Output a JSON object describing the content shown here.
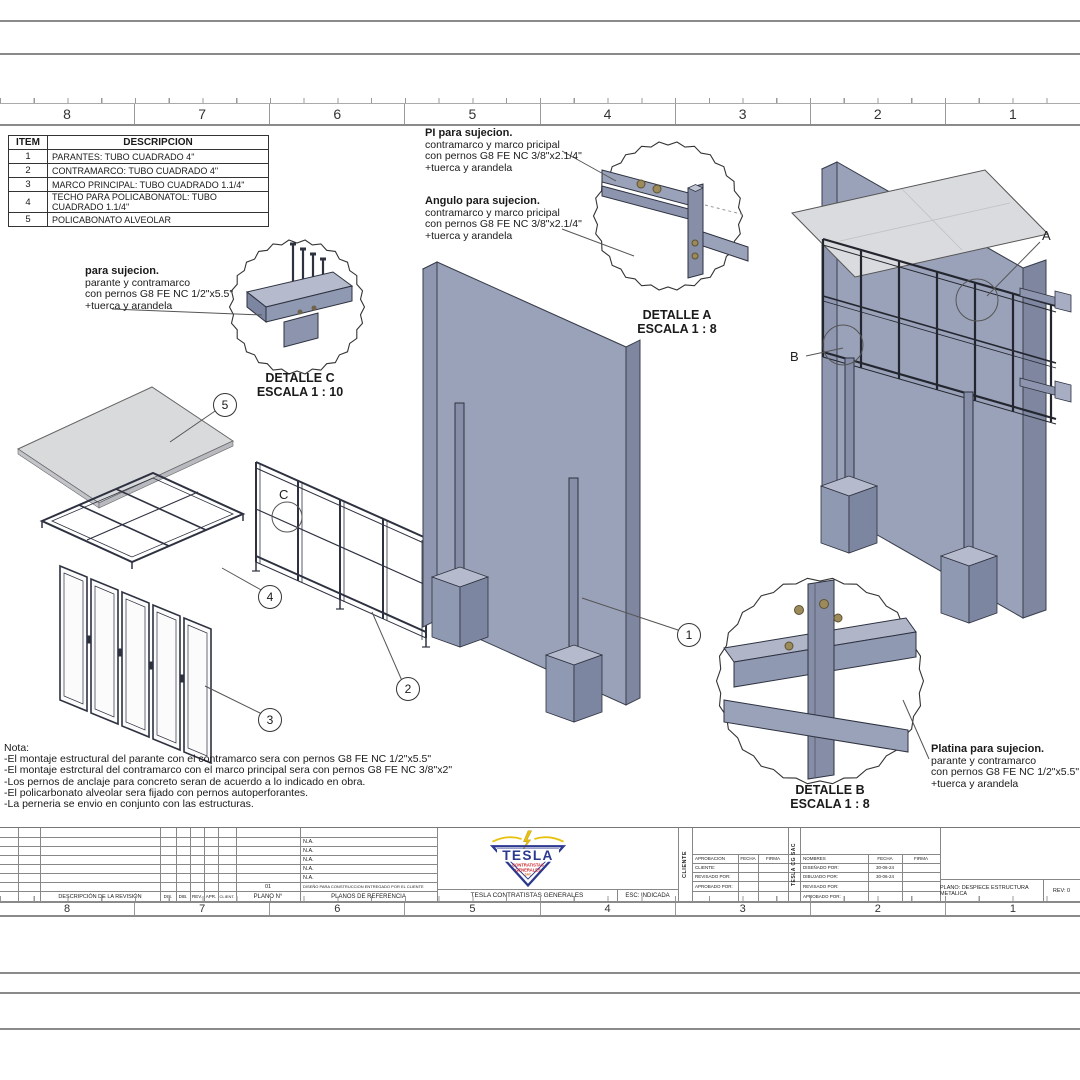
{
  "rulers": {
    "top": [
      "8",
      "7",
      "6",
      "5",
      "4",
      "3",
      "2",
      "1"
    ],
    "bottom": [
      "8",
      "7",
      "6",
      "5",
      "4",
      "3",
      "2",
      "1"
    ]
  },
  "parts_table": {
    "headers": {
      "item": "ITEM",
      "desc": "DESCRIPCION"
    },
    "rows": [
      {
        "item": "1",
        "desc": "PARANTES: TUBO CUADRADO 4\""
      },
      {
        "item": "2",
        "desc": "CONTRAMARCO: TUBO CUADRADO 4\""
      },
      {
        "item": "3",
        "desc": "MARCO PRINCIPAL: TUBO CUADRADO 1.1/4\""
      },
      {
        "item": "4",
        "desc": "TECHO PARA POLICABONATOL: TUBO CUADRADO 1.1/4\""
      },
      {
        "item": "5",
        "desc": "POLICABONATO ALVEOLAR"
      }
    ]
  },
  "annotations": {
    "pi": {
      "title": "PI para sujecion.",
      "lines": [
        "contramarco y marco pricipal",
        "con pernos G8 FE NC 3/8\"x2.1/4\"",
        "+tuerca y arandela"
      ]
    },
    "angulo": {
      "title": "Angulo para sujecion.",
      "lines": [
        "contramarco y marco pricipal",
        "con pernos G8 FE NC 3/8\"x2.1/4\"",
        "+tuerca y arandela"
      ]
    },
    "parante": {
      "title": "para sujecion.",
      "lines": [
        "parante y contramarco",
        "con pernos G8 FE NC 1/2\"x5.5\"",
        "+tuerca y arandela"
      ]
    },
    "platina": {
      "title": "Platina para sujecion.",
      "lines": [
        "parante y contramarco",
        "con pernos G8 FE NC 1/2\"x5.5\"",
        "+tuerca y arandela"
      ]
    }
  },
  "details": {
    "a": {
      "title": "DETALLE A",
      "scale": "ESCALA 1 : 8"
    },
    "b": {
      "title": "DETALLE B",
      "scale": "ESCALA 1 : 8"
    },
    "c": {
      "title": "DETALLE C",
      "scale": "ESCALA 1 : 10"
    }
  },
  "balloons": {
    "b1": "1",
    "b2": "2",
    "b3": "3",
    "b4": "4",
    "b5": "5",
    "la": "A",
    "lb": "B",
    "lc": "C"
  },
  "notes": {
    "title": "Nota:",
    "lines": [
      "-El montaje estructural del parante con el contramarco sera con pernos G8 FE NC 1/2\"x5.5\"",
      "-El montaje estrctural del contramarco con el marco principal sera con pernos G8 FE NC 3/8\"x2\"",
      "-Los pernos de anclaje para concreto seran de acuerdo a lo indicado en obra.",
      "-El policarbonato alveolar sera fijado con pernos autoperforantes.",
      "-La perneria se envio en conjunto con las estructuras."
    ]
  },
  "title_block": {
    "revision": {
      "desc_header": "DESCRIPCIÓN DE LA REVISIÓN",
      "cols": [
        "DIS.",
        "DIB.",
        "REV.",
        "APR.",
        "CLIENT."
      ],
      "plano_n_header": "PLANO N°",
      "plano_n_value": "01",
      "ref_header": "PLANOS DE REFERENCIA",
      "ref_rows": [
        "N.A.",
        "N.A.",
        "N.A.",
        "N.A.",
        "N.A."
      ],
      "ref_note": "DISEÑO PARA CONSTRUCCION ENTREGADO POR EL CLIENTE"
    },
    "company_name": "TESLA CONTRATISTAS GENERALES",
    "esc": "ESC: INDICADA",
    "cliente_label": "CLIENTE",
    "approval": {
      "h1": "APROBACION",
      "h2": "FECHA",
      "h3": "FIRMA",
      "rows": [
        "CLIENTE:",
        "REVISADO POR:",
        "APROBADO POR:"
      ]
    },
    "tesla_cg": "TESLA CG SAC",
    "names": {
      "h1": "NOMBRES",
      "h2": "FECHA",
      "h3": "FIRMA",
      "rows": [
        {
          "label": "DISEÑADO POR:",
          "fecha": "30-06-24"
        },
        {
          "label": "DIBUJADO POR:",
          "fecha": "30-06-24"
        },
        {
          "label": "REVISADO POR:",
          "fecha": ""
        },
        {
          "label": "APROBADO POR:",
          "fecha": ""
        }
      ]
    },
    "plano": "PLANO: DESPIECE ESTRUCTURA METALICA",
    "rev": "REV: 0",
    "logo": {
      "name": "TESLA",
      "sub1": "CONTRATISTAS",
      "sub2": "GENERALES",
      "sub3": "SAC"
    }
  },
  "colors": {
    "logo_blue": "#2b3990",
    "logo_red": "#cc2127",
    "logo_yellow": "#e8c10f",
    "metal": "#9aa2b9",
    "metal_dark": "#7e86a0",
    "metal_light": "#c0c5d3",
    "bolt": "#9c8a5a",
    "sheet": "#d9dadc",
    "line": "#8a8a8a"
  }
}
